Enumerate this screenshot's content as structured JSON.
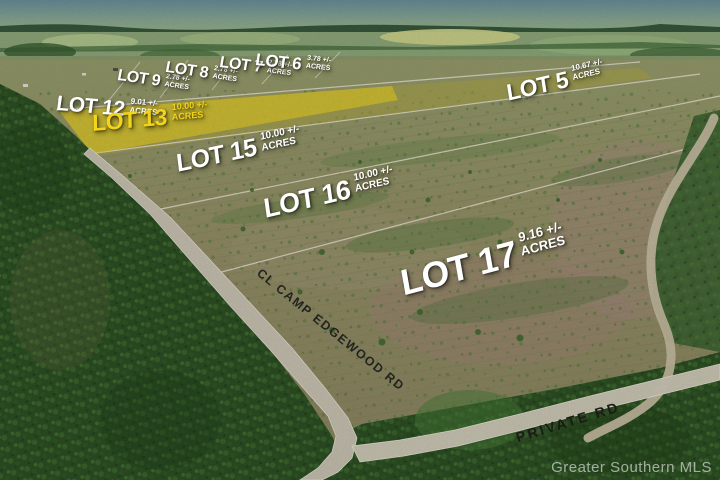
{
  "meta": {
    "description": "Aerial photograph of a rural land subdivision with overlaid lot boundaries, lot numbers, acreage and road names",
    "watermark": "Greater Southern MLS"
  },
  "colors": {
    "highlight_lot": "#f2d41c",
    "lot_label_text": "#ffffff",
    "road_label_text": "#23231f",
    "forest_green": "#2e5226",
    "cleared_land": "#97916a",
    "road_surface": "#d2ccba"
  },
  "lots": [
    {
      "id": 9,
      "label": "LOT 9",
      "acres": "2.78 +/-",
      "unit": "ACRES",
      "highlighted": false
    },
    {
      "id": 8,
      "label": "LOT 8",
      "acres": "2.78 +/-",
      "unit": "ACRES",
      "highlighted": false
    },
    {
      "id": 7,
      "label": "LOT 7",
      "acres": "2.78 +/-",
      "unit": "ACRES",
      "highlighted": false
    },
    {
      "id": 6,
      "label": "LOT 6",
      "acres": "3.78 +/-",
      "unit": "ACRES",
      "highlighted": false
    },
    {
      "id": 12,
      "label": "LOT 12",
      "acres": "9.01 +/-",
      "unit": "ACRES",
      "highlighted": false
    },
    {
      "id": 13,
      "label": "LOT 13",
      "acres": "10.00 +/-",
      "unit": "ACRES",
      "highlighted": true
    },
    {
      "id": 15,
      "label": "LOT 15",
      "acres": "10.00 +/-",
      "unit": "ACRES",
      "highlighted": false
    },
    {
      "id": 16,
      "label": "LOT 16",
      "acres": "10.00 +/-",
      "unit": "ACRES",
      "highlighted": false
    },
    {
      "id": 17,
      "label": "LOT 17",
      "acres": "9.16 +/-",
      "unit": "ACRES",
      "highlighted": false
    },
    {
      "id": 5,
      "label": "LOT 5",
      "acres": "10.67 +/-",
      "unit": "ACRES",
      "highlighted": false
    }
  ],
  "roads": [
    {
      "id": "cl-camp-edgewood-rd",
      "label": "CL CAMP EDGEWOOD RD"
    },
    {
      "id": "private-rd",
      "label": "PRIVATE RD"
    }
  ]
}
